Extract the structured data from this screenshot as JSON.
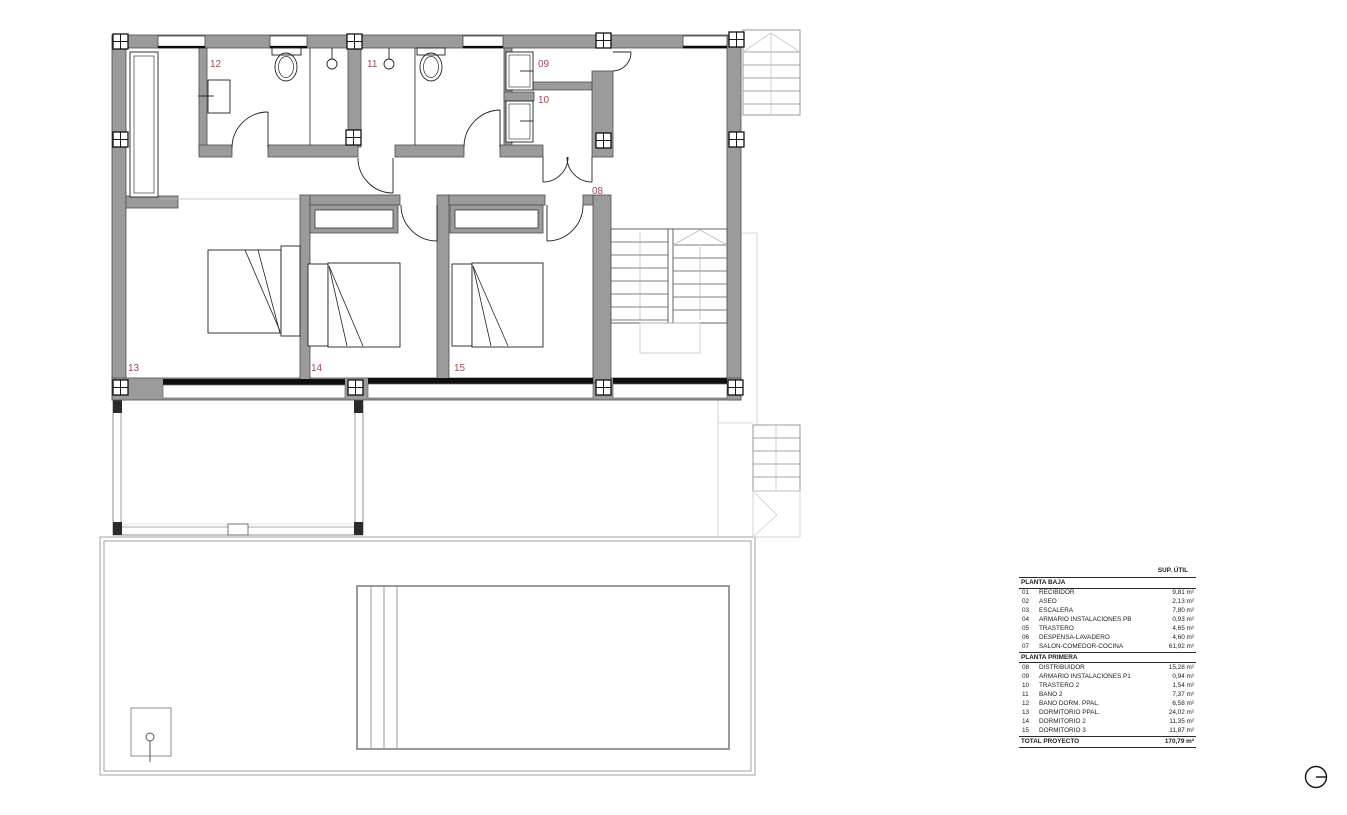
{
  "plan": {
    "wall_color": "#9b9b9b",
    "label_color": "#9e4b50",
    "room_labels": [
      "12",
      "11",
      "09",
      "10",
      "08",
      "13",
      "14",
      "15"
    ]
  },
  "legend_table": {
    "header": "SUP. ÚTIL",
    "sections": [
      {
        "title": "PLANTA BAJA",
        "rows": [
          [
            "01",
            "RECIBIDOR",
            "9,81 m²"
          ],
          [
            "02",
            "ASEO",
            "2,13 m²"
          ],
          [
            "03",
            "ESCALERA",
            "7,80 m²"
          ],
          [
            "04",
            "ARMARIO INSTALACIONES PB",
            "0,93 m²"
          ],
          [
            "05",
            "TRASTERO",
            "4,65 m²"
          ],
          [
            "06",
            "DESPENSA-LAVADERO",
            "4,60 m²"
          ],
          [
            "07",
            "SALÓN-COMEDOR-COCINA",
            "61,92 m²"
          ]
        ]
      },
      {
        "title": "PLANTA PRIMERA",
        "rows": [
          [
            "08",
            "DISTRIBUIDOR",
            "15,28 m²"
          ],
          [
            "09",
            "ARMARIO INSTALACIONES P1",
            "0,94 m²"
          ],
          [
            "10",
            "TRASTERO 2",
            "1,54 m²"
          ],
          [
            "11",
            "BAÑO 2",
            "7,37 m²"
          ],
          [
            "12",
            "BAÑO DORM. PPAL.",
            "6,58 m²"
          ],
          [
            "13",
            "DORMITORIO PPAL.",
            "24,02 m²"
          ],
          [
            "14",
            "DORMITORIO 2",
            "11,35 m²"
          ],
          [
            "15",
            "DORMITORIO 3",
            "11,87 m²"
          ]
        ]
      }
    ],
    "total": {
      "label": "TOTAL PROYECTO",
      "value": "170,79 m²"
    }
  }
}
